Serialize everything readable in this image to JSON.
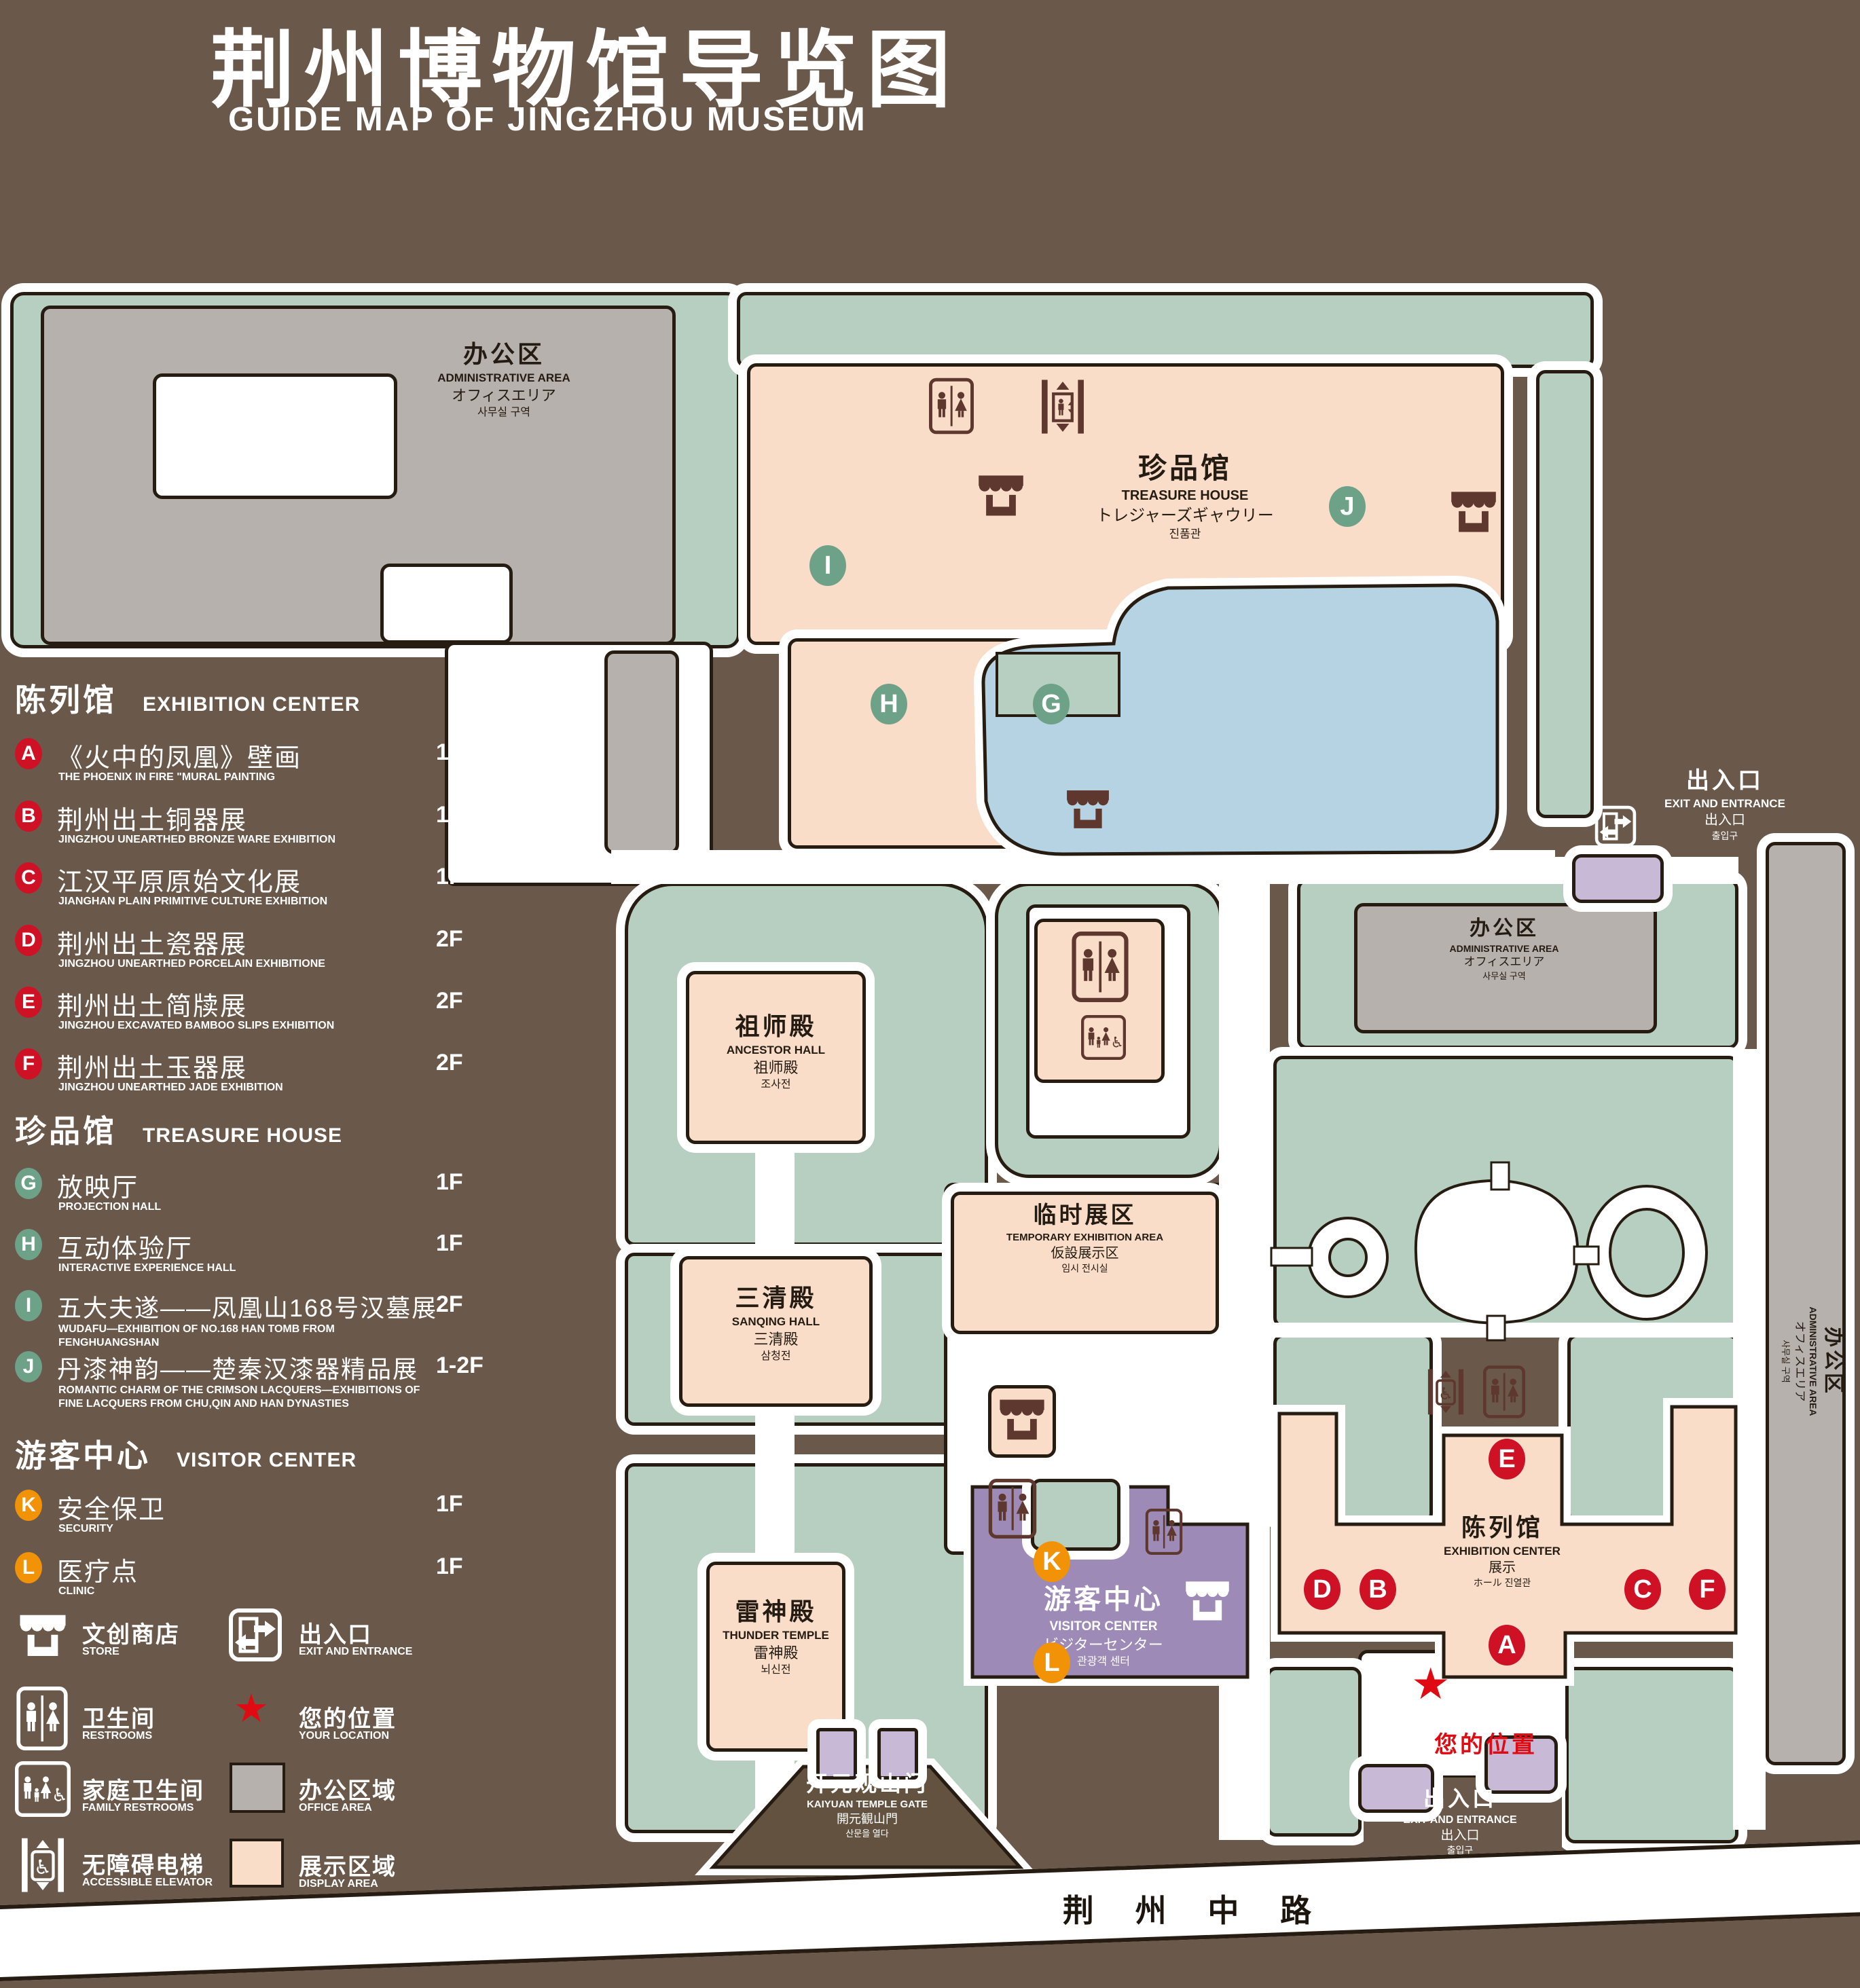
{
  "header": {
    "title_zh": "荆州博物馆导览图",
    "title_en": "GUIDE MAP OF JINGZHOU MUSEUM"
  },
  "legend": {
    "sections": [
      {
        "title_zh": "陈列馆",
        "title_en": "EXHIBITION CENTER",
        "badge_color": "#cf1126",
        "items": [
          {
            "letter": "A",
            "zh": "《火中的凤凰》壁画",
            "en": "THE PHOENIX IN FIRE \"MURAL PAINTING",
            "floor": "1F"
          },
          {
            "letter": "B",
            "zh": "荆州出土铜器展",
            "en": "JINGZHOU UNEARTHED BRONZE WARE EXHIBITION",
            "floor": "1F"
          },
          {
            "letter": "C",
            "zh": "江汉平原原始文化展",
            "en": "JIANGHAN PLAIN PRIMITIVE CULTURE EXHIBITION",
            "floor": "1F"
          },
          {
            "letter": "D",
            "zh": "荆州出土瓷器展",
            "en": "JINGZHOU UNEARTHED PORCELAIN EXHIBITIONE",
            "floor": "2F"
          },
          {
            "letter": "E",
            "zh": "荆州出土简牍展",
            "en": "JINGZHOU EXCAVATED BAMBOO SLIPS EXHIBITION",
            "floor": "2F"
          },
          {
            "letter": "F",
            "zh": "荆州出土玉器展",
            "en": "JINGZHOU UNEARTHED JADE EXHIBITION",
            "floor": "2F"
          }
        ]
      },
      {
        "title_zh": "珍品馆",
        "title_en": "TREASURE HOUSE",
        "badge_color": "#6da289",
        "items": [
          {
            "letter": "G",
            "zh": "放映厅",
            "en": "PROJECTION HALL",
            "floor": "1F"
          },
          {
            "letter": "H",
            "zh": "互动体验厅",
            "en": "INTERACTIVE EXPERIENCE HALL",
            "floor": "1F"
          },
          {
            "letter": "I",
            "zh": "五大夫遂——凤凰山168号汉墓展",
            "en": "WUDAFU—EXHIBITION OF NO.168 HAN TOMB FROM FENGHUANGSHAN",
            "floor": "2F"
          },
          {
            "letter": "J",
            "zh": "丹漆神韵——楚秦汉漆器精品展",
            "en": "ROMANTIC CHARM OF THE CRIMSON LACQUERS—EXHIBITIONS OF FINE LACQUERS FROM CHU,QIN AND HAN DYNASTIES",
            "floor": "1-2F"
          }
        ]
      },
      {
        "title_zh": "游客中心",
        "title_en": "VISITOR CENTER",
        "badge_color": "#f19207",
        "items": [
          {
            "letter": "K",
            "zh": "安全保卫",
            "en": "SECURITY",
            "floor": "1F"
          },
          {
            "letter": "L",
            "zh": "医疗点",
            "en": "CLINIC",
            "floor": "1F"
          }
        ]
      }
    ],
    "symbols": [
      {
        "icon": "store-icon",
        "zh": "文创商店",
        "en": "STORE"
      },
      {
        "icon": "exit-icon",
        "zh": "出入口",
        "en": "EXIT AND ENTRANCE"
      },
      {
        "icon": "restroom-icon",
        "zh": "卫生间",
        "en": "RESTROOMS"
      },
      {
        "icon": "location-star-icon",
        "zh": "您的位置",
        "en": "YOUR LOCATION",
        "color": "#e00b12"
      },
      {
        "icon": "family-restroom-icon",
        "zh": "家庭卫生间",
        "en": "FAMILY RESTROOMS"
      },
      {
        "icon": "office-area-swatch",
        "zh": "办公区域",
        "en": "OFFICE AREA",
        "color": "#b6b1ad"
      },
      {
        "icon": "accessible-elevator-icon",
        "zh": "无障碍电梯",
        "en": "ACCESSIBLE ELEVATOR"
      },
      {
        "icon": "display-area-swatch",
        "zh": "展示区域",
        "en": "DISPLAY AREA",
        "color": "#f9ddc9"
      },
      {
        "icon": "elevator-icon",
        "zh": "电梯",
        "en": "Elevator"
      }
    ]
  },
  "map": {
    "admin": {
      "l1": "办公区",
      "l2": "ADMINISTRATIVE AREA",
      "l3": "オフィスエリア",
      "l4": "사무실 구역"
    },
    "treasure": {
      "l1": "珍品馆",
      "l2": "TREASURE HOUSE",
      "l3": "トレジャーズギャウリー",
      "l4": "진품관"
    },
    "ancestor": {
      "l1": "祖师殿",
      "l2": "ANCESTOR HALL",
      "l3": "祖师殿",
      "l4": "조사전"
    },
    "sanqing": {
      "l1": "三清殿",
      "l2": "SANQING HALL",
      "l3": "三清殿",
      "l4": "삼청전"
    },
    "thunder": {
      "l1": "雷神殿",
      "l2": "THUNDER TEMPLE",
      "l3": "雷神殿",
      "l4": "뇌신전"
    },
    "temp": {
      "l1": "临时展区",
      "l2": "TEMPORARY EXHIBITION AREA",
      "l3": "仮設展示区",
      "l4": "임시 전시실"
    },
    "visitor": {
      "l1": "游客中心",
      "l2": "VISITOR CENTER",
      "l3": "ビジターセンター",
      "l4": "관광객 센터"
    },
    "exhibition": {
      "l1": "陈列馆",
      "l2": "EXHIBITION CENTER",
      "l3": "展示",
      "l4": "ホール 진열관"
    },
    "gate": {
      "l1": "开元观山门",
      "l2": "KAIYUAN TEMPLE GATE",
      "l3": "開元観山門",
      "l4": "산문을 열다"
    },
    "exit": {
      "l1": "出入口",
      "l2": "EXIT AND ENTRANCE",
      "l3": "出入口",
      "l4": "출입구"
    },
    "your_location": "您的位置",
    "road": "荆 州 中 路",
    "location_star": "★"
  }
}
